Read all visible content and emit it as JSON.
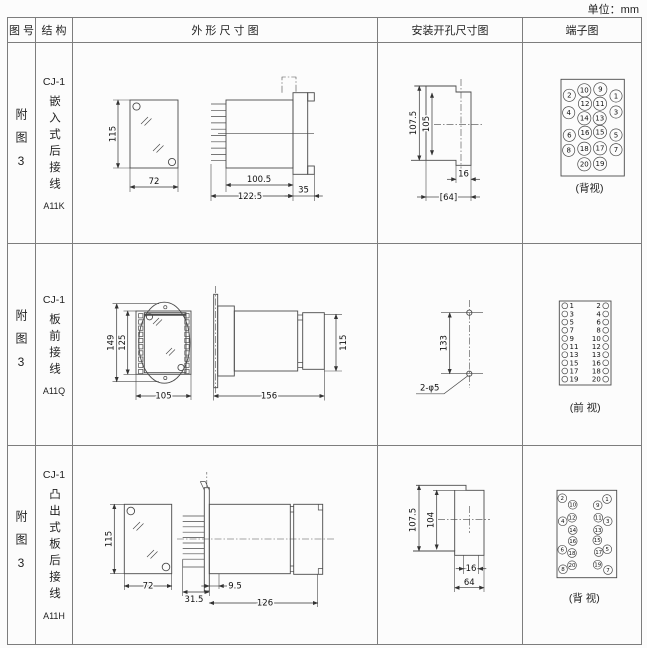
{
  "unit_label": "单位：mm",
  "header": {
    "figure": "图 号",
    "structure": "结 构",
    "outline": "外 形 尺 寸 图",
    "mounting": "安装开孔尺寸图",
    "terminal": "端子图"
  },
  "rows": [
    {
      "figure": "附图3",
      "model": "CJ-1",
      "structure_text": "嵌入式后接线",
      "code": "A11K",
      "dims": {
        "h": "115",
        "w": "72",
        "d1": "100.5",
        "d2": "122.5",
        "d3": "35"
      },
      "mount": {
        "m1": "107.5",
        "m2": "105",
        "m3": "16",
        "m4": "[64]"
      },
      "terminal_view": "(背视)",
      "terminal_labels": [
        "2",
        "10",
        "9",
        "1",
        "4",
        "12",
        "11",
        "3",
        "14",
        "13",
        "6",
        "16",
        "15",
        "5",
        "8",
        "18",
        "17",
        "7",
        "20",
        "19"
      ]
    },
    {
      "figure": "附图3",
      "model": "CJ-1",
      "structure_text": "板前接线",
      "code": "A11Q",
      "dims": {
        "h": "149",
        "h2": "125",
        "w": "105",
        "d": "156",
        "sh": "115"
      },
      "mount": {
        "m1": "133",
        "m2": "2-φ5"
      },
      "terminal_view": "(前 视)",
      "terminal_left": [
        "1",
        "3",
        "5",
        "7",
        "9",
        "11",
        "13",
        "15",
        "17",
        "19"
      ],
      "terminal_right": [
        "2",
        "4",
        "6",
        "8",
        "10",
        "12",
        "13",
        "16",
        "18",
        "20"
      ]
    },
    {
      "figure": "附图3",
      "model": "CJ-1",
      "structure_text": "凸出式板后接线",
      "code": "A11H",
      "dims": {
        "h": "115",
        "w": "72",
        "d1": "31.5",
        "d2": "9.5",
        "d3": "126"
      },
      "mount": {
        "m1": "107.5",
        "m2": "104",
        "m3": "16",
        "m4": "64"
      },
      "terminal_view": "(背 视)",
      "terminal_labels": [
        "2",
        "1",
        "10",
        "9",
        "4",
        "12",
        "11",
        "3",
        "14",
        "13",
        "16",
        "15",
        "6",
        "18",
        "17",
        "5",
        "20",
        "19",
        "8",
        "7"
      ]
    }
  ]
}
